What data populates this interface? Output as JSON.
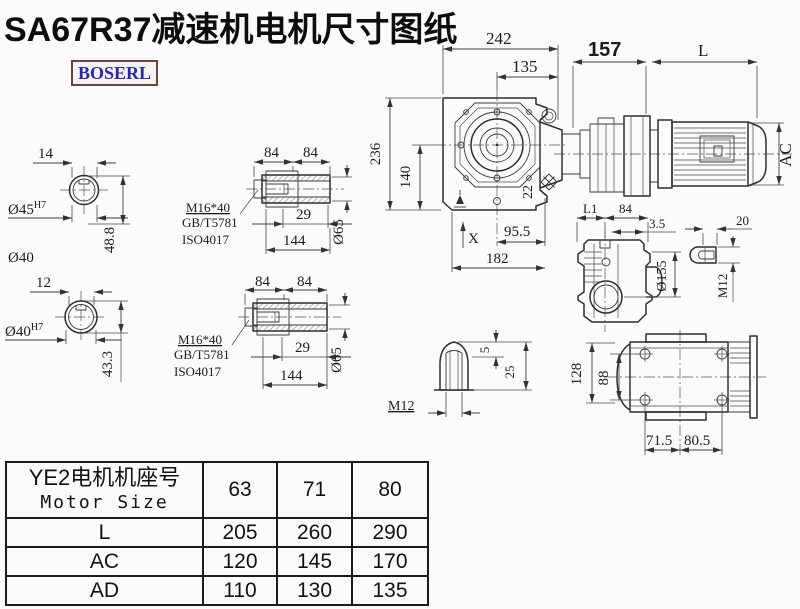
{
  "title": "SA67R37减速机电机尺寸图纸",
  "brand": "BOSERL",
  "colors": {
    "line": "#2e2e2e",
    "brand_text": "#2628b4",
    "brand_border": "#6e4240",
    "background": "#fbfbfb"
  },
  "views": {
    "left_top": {
      "key": "14",
      "bore": "Ø45",
      "tol": "H7",
      "height": "48.8",
      "od": "Ø40"
    },
    "left_bottom": {
      "key": "12",
      "bore": "Ø40",
      "tol": "H7",
      "height": "43.3"
    },
    "shaft_top": {
      "d84a": "84",
      "d84b": "84",
      "bolt": "M16*40",
      "std1": "GB/T5781",
      "std2": "ISO4017",
      "d29": "29",
      "d144": "144",
      "dia": "Ø65"
    },
    "shaft_bottom": {
      "d84a": "84",
      "d84b": "84",
      "bolt": "M16*40",
      "std1": "GB/T5781",
      "std2": "ISO4017",
      "d29": "29",
      "d144": "144",
      "dia": "Ø65"
    },
    "main": {
      "w242": "242",
      "w135": "135",
      "w157": "157",
      "L": "L",
      "h236": "236",
      "h140": "140",
      "n22": "22",
      "w955": "95.5",
      "w182": "182",
      "x": "X",
      "ac": "AC"
    },
    "side": {
      "l1": "L1",
      "w84": "84",
      "off": "3.5",
      "dia": "Ø155"
    },
    "slot": {
      "w20": "20",
      "m12": "M12"
    },
    "plug": {
      "m12": "M12",
      "d5": "5",
      "d25": "25"
    },
    "bottom": {
      "h128": "128",
      "h88": "88",
      "w715": "71.5",
      "w805": "80.5"
    }
  },
  "table": {
    "header_cn": "YE2电机机座号",
    "header_en": "Motor Size",
    "sizes": [
      "63",
      "71",
      "80"
    ],
    "rows": [
      {
        "label": "L",
        "values": [
          "205",
          "260",
          "290"
        ]
      },
      {
        "label": "AC",
        "values": [
          "120",
          "145",
          "170"
        ]
      },
      {
        "label": "AD",
        "values": [
          "110",
          "130",
          "135"
        ]
      }
    ]
  }
}
